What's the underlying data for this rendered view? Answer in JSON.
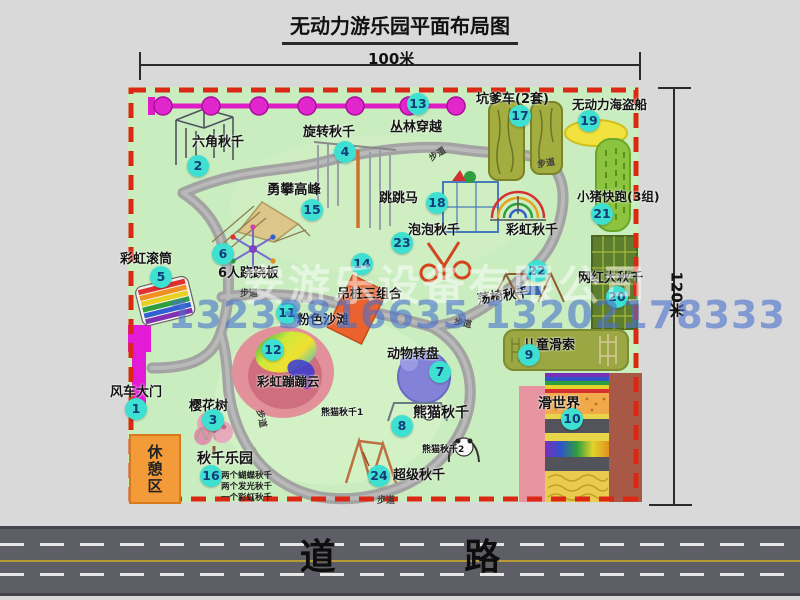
{
  "title": "无动力游乐园平面布局图",
  "dimensions": {
    "width_label": "100米",
    "height_label": "120米"
  },
  "road_label": "道 路",
  "watermark": {
    "company": "安游乐设备有限公司",
    "phone": "13233816635 13202178333"
  },
  "rest_area_label": "休憩区",
  "items": [
    {
      "num": "1",
      "label": "风车大门"
    },
    {
      "num": "2",
      "label": "六角秋千"
    },
    {
      "num": "3",
      "label": "樱花树"
    },
    {
      "num": "4",
      "label": "旋转秋千"
    },
    {
      "num": "5",
      "label": "彩虹滚筒"
    },
    {
      "num": "6",
      "label": "6人跷跷板"
    },
    {
      "num": "7",
      "label": "动物转盘"
    },
    {
      "num": "8",
      "label": "熊猫秋千"
    },
    {
      "num": "9",
      "label": "儿童滑索"
    },
    {
      "num": "10",
      "label": "滑世界"
    },
    {
      "num": "11",
      "label": "粉色沙滩"
    },
    {
      "num": "12",
      "label": "彩虹蹦蹦云"
    },
    {
      "num": "13",
      "label": "丛林穿越"
    },
    {
      "num": "14",
      "label": "吊桩三组合"
    },
    {
      "num": "15",
      "label": "勇攀高峰"
    },
    {
      "num": "16",
      "label": "秋千乐园"
    },
    {
      "num": "17",
      "label": "坑爹车(2套)"
    },
    {
      "num": "18",
      "label": "跳跳马"
    },
    {
      "num": "19",
      "label": "无动力海盗船"
    },
    {
      "num": "20",
      "label": "网红大秋千"
    },
    {
      "num": "21",
      "label": "小猪快跑(3组)"
    },
    {
      "num": "22",
      "label": "荡椅秋千"
    },
    {
      "num": "23",
      "label": "泡泡秋千"
    },
    {
      "num": "24",
      "label": "超级秋千"
    }
  ],
  "extras": {
    "rainbow_swing": "彩虹秋千",
    "panda_swing_1": "熊猫秋千1",
    "panda_swing_2": "熊猫秋千2",
    "swing_park_note_1": "两个蝴蝶秋千",
    "swing_park_note_2": "两个发光秋千",
    "swing_park_note_3": "一个彩虹秋千",
    "path_label": "步道"
  },
  "colors": {
    "marker_teal": "#3EE0D2",
    "zipline_magenta": "#DF1CC6",
    "border_red": "#DD2715",
    "map_green": "#C9EDBE",
    "road_gray": "#5E5E66",
    "rest_area_orange": "#F29B38",
    "watermark_blue": "#4870CD"
  }
}
